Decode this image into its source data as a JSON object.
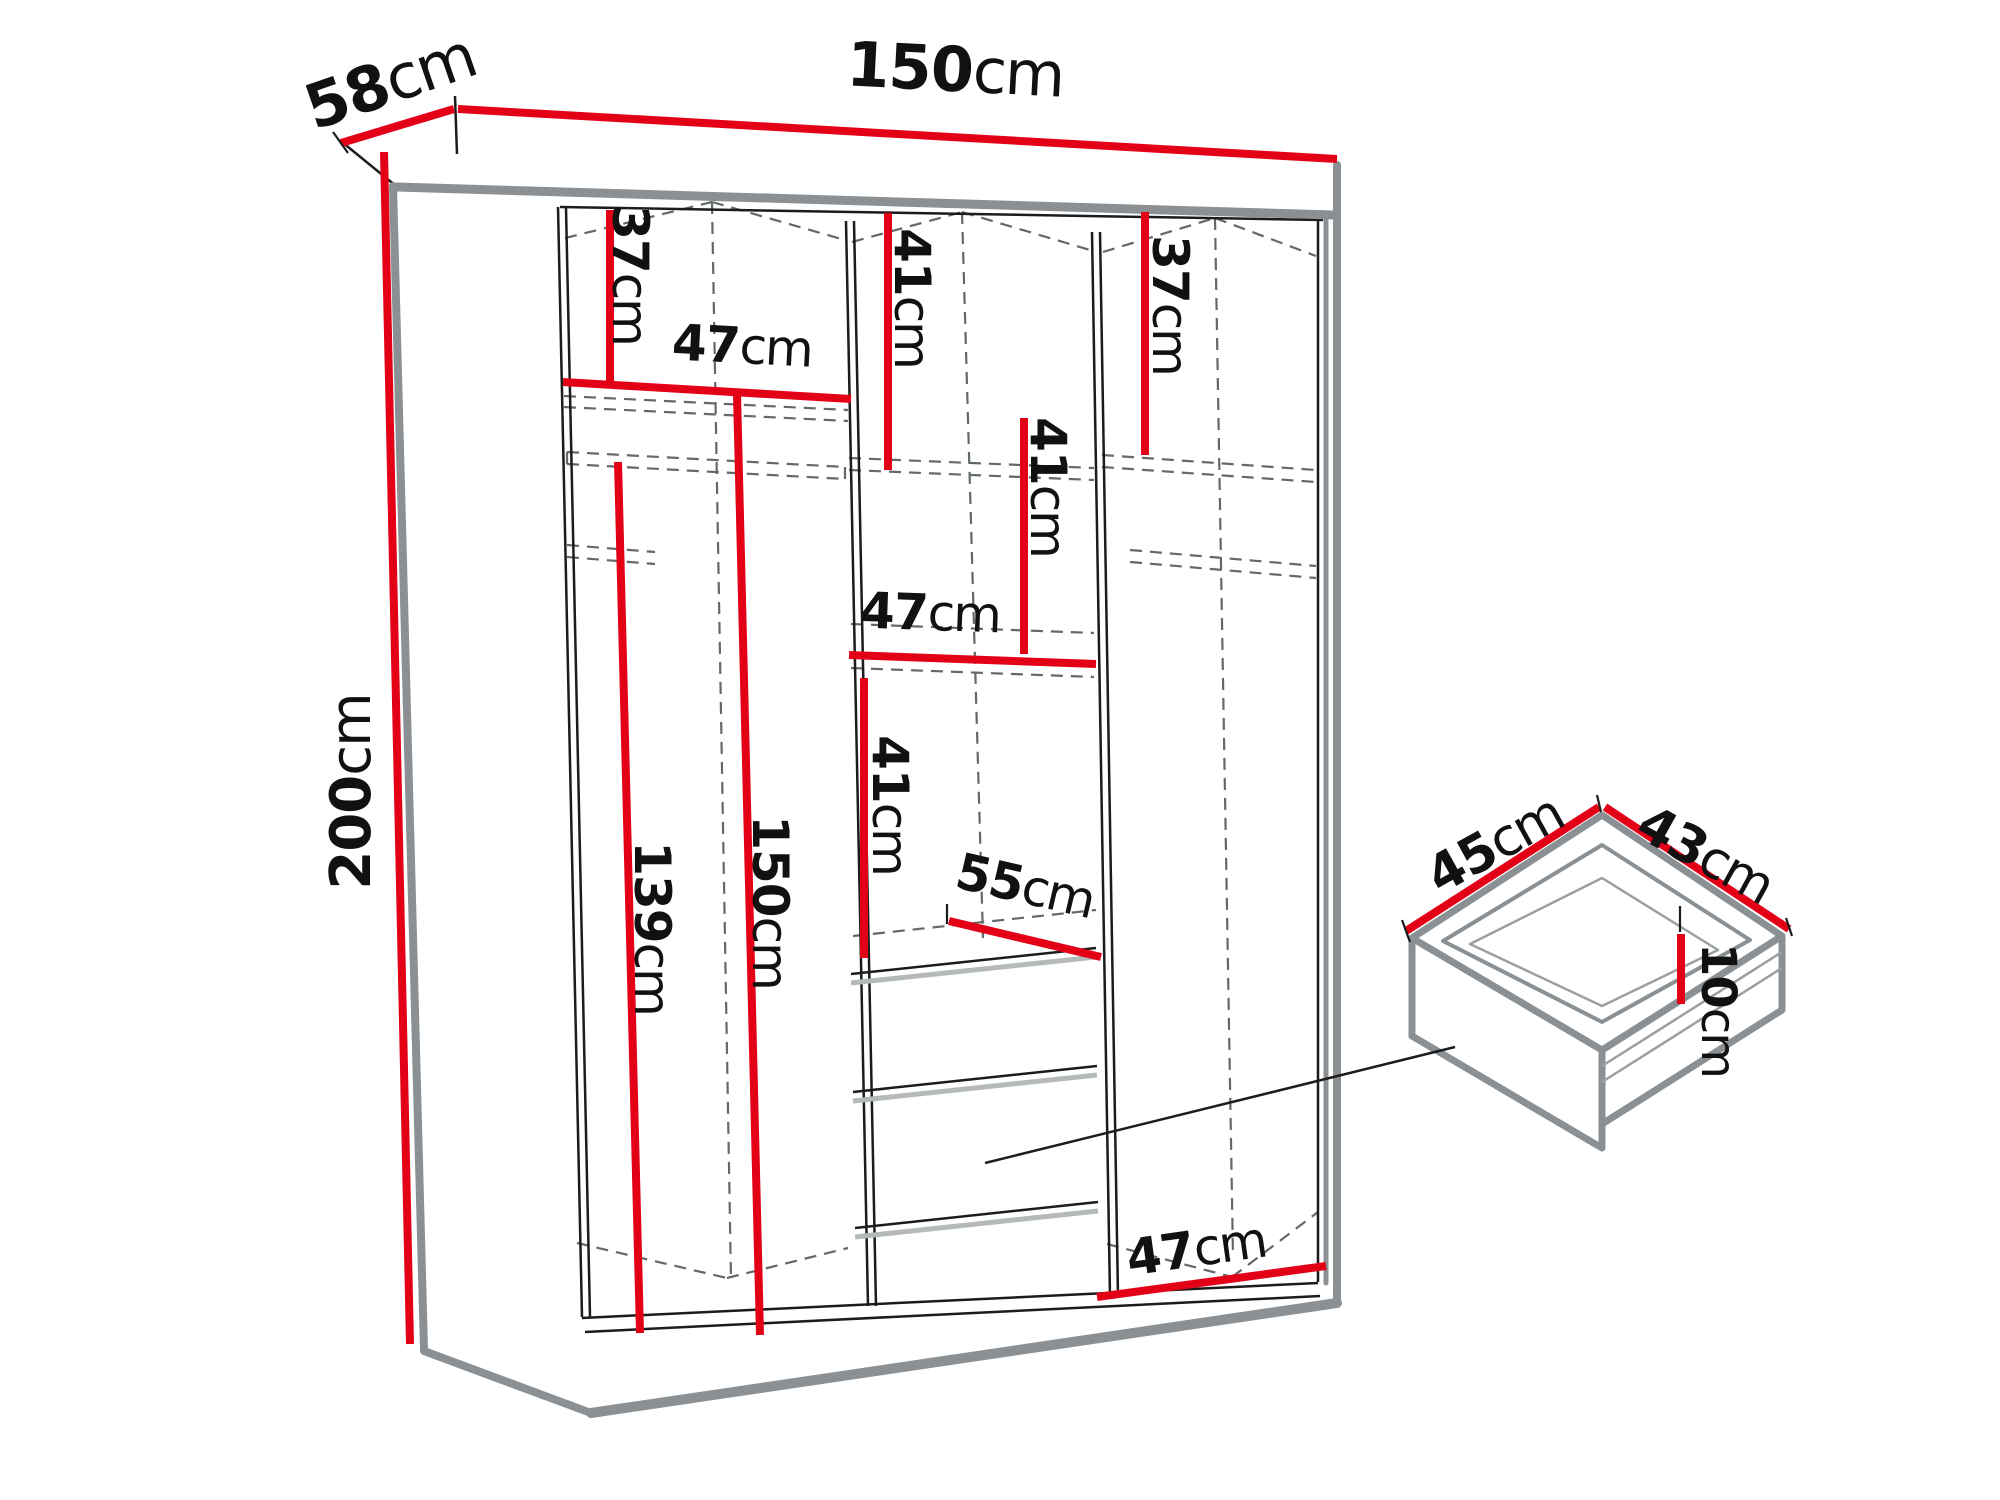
{
  "diagram": {
    "kind": "furniture dimension drawing",
    "subject": "three-section wardrobe with shelves, hanging rails and drawers, plus detail view of one drawer",
    "colors": {
      "dimension_red": "#e30016",
      "outline_gray": "#8a9093",
      "shadow_gray": "#b4b9ba",
      "dashed_gray": "#63686a",
      "line_black": "#1c1c1c",
      "background": "#ffffff",
      "label_text": "#111111"
    },
    "wardrobe": {
      "overall_width": "150cm",
      "overall_depth": "58cm",
      "overall_height": "200cm",
      "left_section": {
        "top_compartment_height": "37cm",
        "shelf_width": "47cm",
        "height_below_rail": "139cm",
        "interior_height_below_shelf": "150cm",
        "has_hanging_rail": true
      },
      "middle_section": {
        "upper_compartment_height": "41cm",
        "second_compartment_height": "41cm",
        "shelf_width": "47cm",
        "third_compartment_height": "41cm",
        "top_of_drawers_diagonal": "55cm",
        "drawer_count": 3
      },
      "right_section": {
        "top_compartment_height": "37cm",
        "bottom_width": "47cm",
        "has_hanging_rail": true
      }
    },
    "drawer_detail": {
      "width": "45cm",
      "depth": "43cm",
      "height": "10cm"
    }
  },
  "labels": {
    "width_top": {
      "num": "150",
      "unit": "cm"
    },
    "depth_top": {
      "num": "58",
      "unit": "cm"
    },
    "height_left": {
      "num": "200",
      "unit": "cm"
    },
    "left_shelf_h": {
      "num": "37",
      "unit": "cm"
    },
    "left_shelf_w": {
      "num": "47",
      "unit": "cm"
    },
    "left_rail_h": {
      "num": "139",
      "unit": "cm"
    },
    "left_inner_h": {
      "num": "150",
      "unit": "cm"
    },
    "mid_c1": {
      "num": "41",
      "unit": "cm"
    },
    "mid_c2": {
      "num": "41",
      "unit": "cm"
    },
    "mid_shelf_w": {
      "num": "47",
      "unit": "cm"
    },
    "mid_c3": {
      "num": "41",
      "unit": "cm"
    },
    "mid_diag": {
      "num": "55",
      "unit": "cm"
    },
    "right_shelf_h": {
      "num": "37",
      "unit": "cm"
    },
    "right_bottom_w": {
      "num": "47",
      "unit": "cm"
    },
    "drawer_w": {
      "num": "45",
      "unit": "cm"
    },
    "drawer_d": {
      "num": "43",
      "unit": "cm"
    },
    "drawer_h": {
      "num": "10",
      "unit": "cm"
    }
  }
}
